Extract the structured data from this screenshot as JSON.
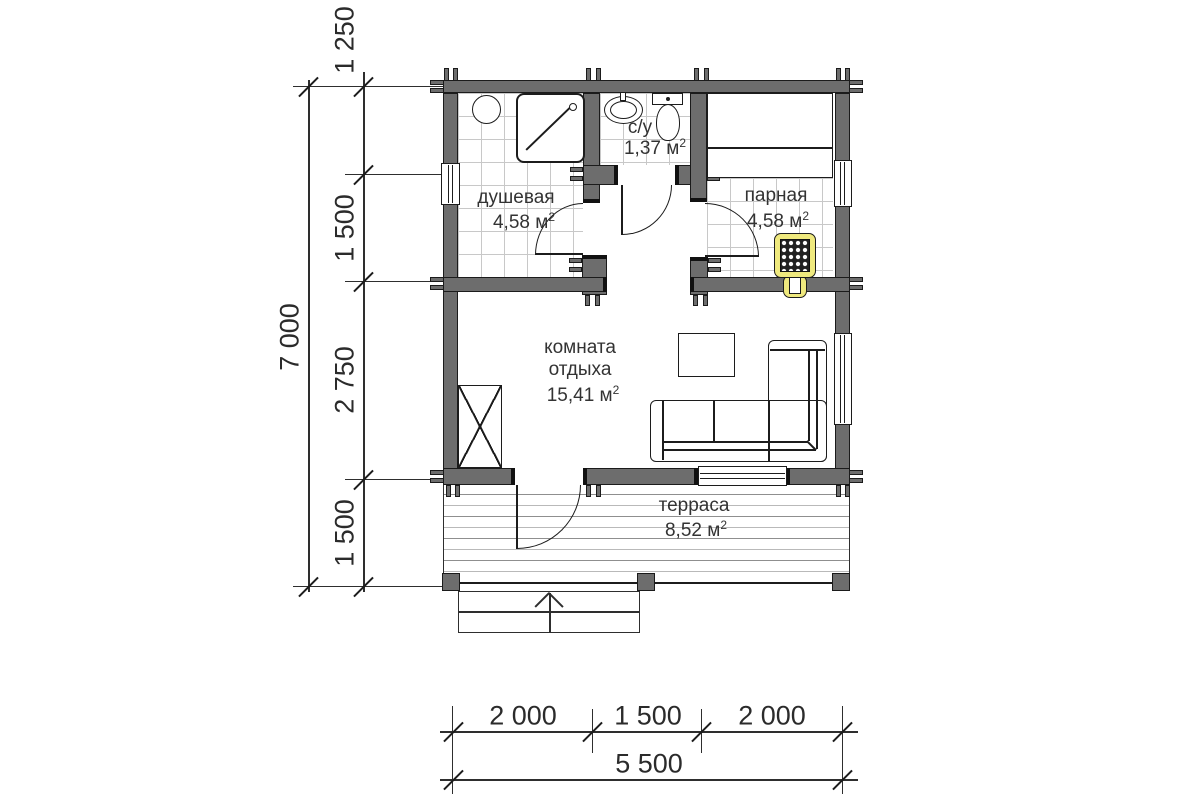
{
  "rooms": [
    {
      "name": "душевая",
      "area": "4,58 м",
      "area_sup": "2"
    },
    {
      "name": "с/у",
      "area": "1,37 м",
      "area_sup": "2"
    },
    {
      "name": "парная",
      "area": "4,58 м",
      "area_sup": "2"
    },
    {
      "name": "комната",
      "name2": "отдыха",
      "area": "15,41 м",
      "area_sup": "2"
    },
    {
      "name": "терраса",
      "area": "8,52 м",
      "area_sup": "2"
    }
  ],
  "dimensions": {
    "left_total": "7 000",
    "left_segments": [
      "1 250",
      "1 500",
      "2 750",
      "1 500"
    ],
    "bottom_segments": [
      "2 000",
      "1 500",
      "2 000"
    ],
    "bottom_total": "5 500"
  },
  "colors": {
    "wall": "#6d6d6d",
    "stove_accent": "#efe97e",
    "tile_line": "#c8c8c8",
    "dimension_text": "#2b2b2b"
  }
}
